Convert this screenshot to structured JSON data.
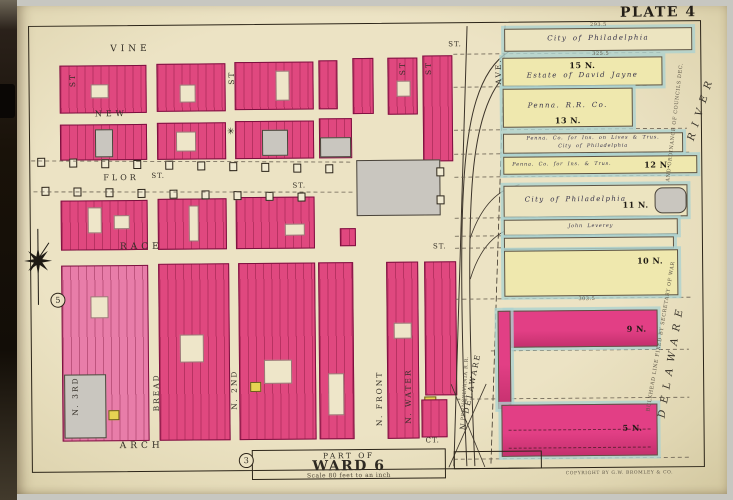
{
  "plate_title": "PLATE 4",
  "ward_box": {
    "part_of": "PART OF",
    "name": "WARD 6",
    "scale": "Scale 80 feet to an inch",
    "adjacent_plate_bottom": "3",
    "adjacent_plate_left": "5"
  },
  "streets": {
    "st_abbrev": "ST",
    "horizontal": {
      "vine": "VINE",
      "vine_ext": "ST.",
      "new": "NEW",
      "flor": "FLOR",
      "flor_suffix": "ST.",
      "flor_ext": "ST.",
      "race": "RACE",
      "race_ext": "ST.",
      "arch": "ARCH",
      "arch_ext": "CT."
    },
    "vertical": {
      "n3rd": "N. 3RD",
      "bread": "BREAD",
      "n2nd": "N. 2ND",
      "nfront": "N. FRONT",
      "nwater": "N. WATER",
      "ndelaware": "N. DELAWARE",
      "ave": "AVE."
    }
  },
  "piers": [
    {
      "number": "",
      "owner": "City of Philadelphia"
    },
    {
      "number": "15 N.",
      "owner": "Estate of David Jayne"
    },
    {
      "number": "13 N.",
      "owner": "Penna. R.R. Co."
    },
    {
      "number": "",
      "owner": "Penna. Co. for Ins. on Lives & Trus.",
      "owner2": "City of Philadelphia"
    },
    {
      "number": "12 N.",
      "owner": "Penna. Co. for Ins. & Trus."
    },
    {
      "number": "11 N.",
      "owner": "City of Philadelphia"
    },
    {
      "number": "",
      "owner": "John Leverey"
    },
    {
      "number": "",
      "owner": ""
    },
    {
      "number": "10 N.",
      "owner": ""
    },
    {
      "number": "9 N.",
      "owner": ""
    },
    {
      "number": "5 N.",
      "owner": ""
    }
  ],
  "river": {
    "word_upper": "RIVER",
    "word_lower": "DELAWARE"
  },
  "notes": {
    "bulkhead": "BULKHEAD LINE FIXED BY SECRETARY OF WAR",
    "councils": "AND ORDINANCE OF COUNCILS DEC.",
    "railroad": "PENNSYLVANIA R.R.",
    "copyright": "COPYRIGHT BY G.W. BROMLEY & CO."
  },
  "measurements": {
    "m1": "293.5",
    "m2": "325.5",
    "m3": "303.5"
  },
  "symbols": {
    "star": "✳"
  },
  "palette": {
    "page": "#e9e0c2",
    "block_pink": "#e0487f",
    "block_pink_light": "#e87da9",
    "pier_yellow": "#efe8ae",
    "pier_pink": "#e23f85",
    "water_edge": "#b7d8d6",
    "ink": "#2b2318"
  }
}
